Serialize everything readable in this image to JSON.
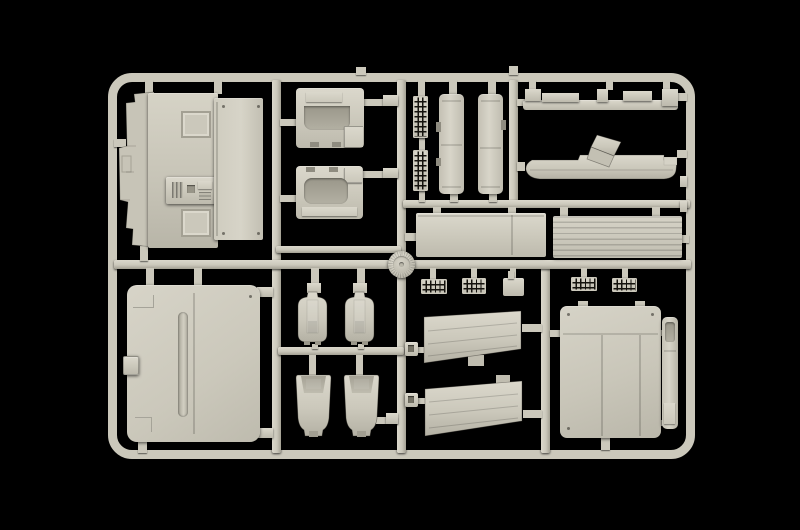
{
  "scene": {
    "type": "photograph",
    "subject": "injection-molded plastic model kit sprue (parts tree) photographed on a black background",
    "background_color": "#000000",
    "material": "light grey styrene plastic",
    "text_visible": "none"
  },
  "palette": {
    "bg": "#000000",
    "plastic": "#cbc8bb",
    "plastic_light": "#dbd8cc",
    "plastic_mid": "#bdbaad",
    "plastic_dark": "#a3a093",
    "plastic_shadow": "#807d72",
    "slot_dark": "#14120d"
  },
  "sprue": {
    "frame": "rounded rectangular outer runner frame with internal vertical and horizontal runners and a round hub at the central junction",
    "parts": [
      {
        "name": "cab-floor-panel",
        "area": "top-left"
      },
      {
        "name": "cab-rear-wall-panel",
        "area": "top-left"
      },
      {
        "name": "dashboard-module-upper",
        "area": "top-center"
      },
      {
        "name": "dashboard-module-lower",
        "area": "top-center"
      },
      {
        "name": "vent-grille-vertical-upper",
        "area": "top-center"
      },
      {
        "name": "vent-grille-vertical-lower",
        "area": "top-center"
      },
      {
        "name": "chassis-side-member-left",
        "area": "top-center"
      },
      {
        "name": "chassis-side-member-right",
        "area": "top-center"
      },
      {
        "name": "roof-spoiler-strip",
        "area": "top-right"
      },
      {
        "name": "wind-deflector-with-bracket-arm",
        "area": "top-right"
      },
      {
        "name": "side-fairing-panel-smooth",
        "area": "middle"
      },
      {
        "name": "side-fairing-panel-ribbed",
        "area": "middle"
      },
      {
        "name": "round-hub-cap",
        "area": "middle-center"
      },
      {
        "name": "cab-roof-panel",
        "area": "bottom-left"
      },
      {
        "name": "seat-backrest-left",
        "area": "bottom-center"
      },
      {
        "name": "seat-backrest-right",
        "area": "bottom-center"
      },
      {
        "name": "seat-cushion-left",
        "area": "bottom-center"
      },
      {
        "name": "seat-cushion-right",
        "area": "bottom-center"
      },
      {
        "name": "intake-grille-1",
        "area": "bottom-center"
      },
      {
        "name": "intake-grille-2",
        "area": "bottom-center"
      },
      {
        "name": "small-mounting-plate",
        "area": "bottom-center"
      },
      {
        "name": "intake-grille-3",
        "area": "bottom-right"
      },
      {
        "name": "intake-grille-4",
        "area": "bottom-right"
      },
      {
        "name": "air-deflector-wedge-upper",
        "area": "bottom-center"
      },
      {
        "name": "air-deflector-wedge-lower",
        "area": "bottom-center"
      },
      {
        "name": "mounting-block-upper",
        "area": "bottom-center"
      },
      {
        "name": "mounting-block-lower",
        "area": "bottom-center"
      },
      {
        "name": "rear-cab-panel-large",
        "area": "bottom-right"
      },
      {
        "name": "door-edge-strip",
        "area": "bottom-right"
      }
    ]
  }
}
